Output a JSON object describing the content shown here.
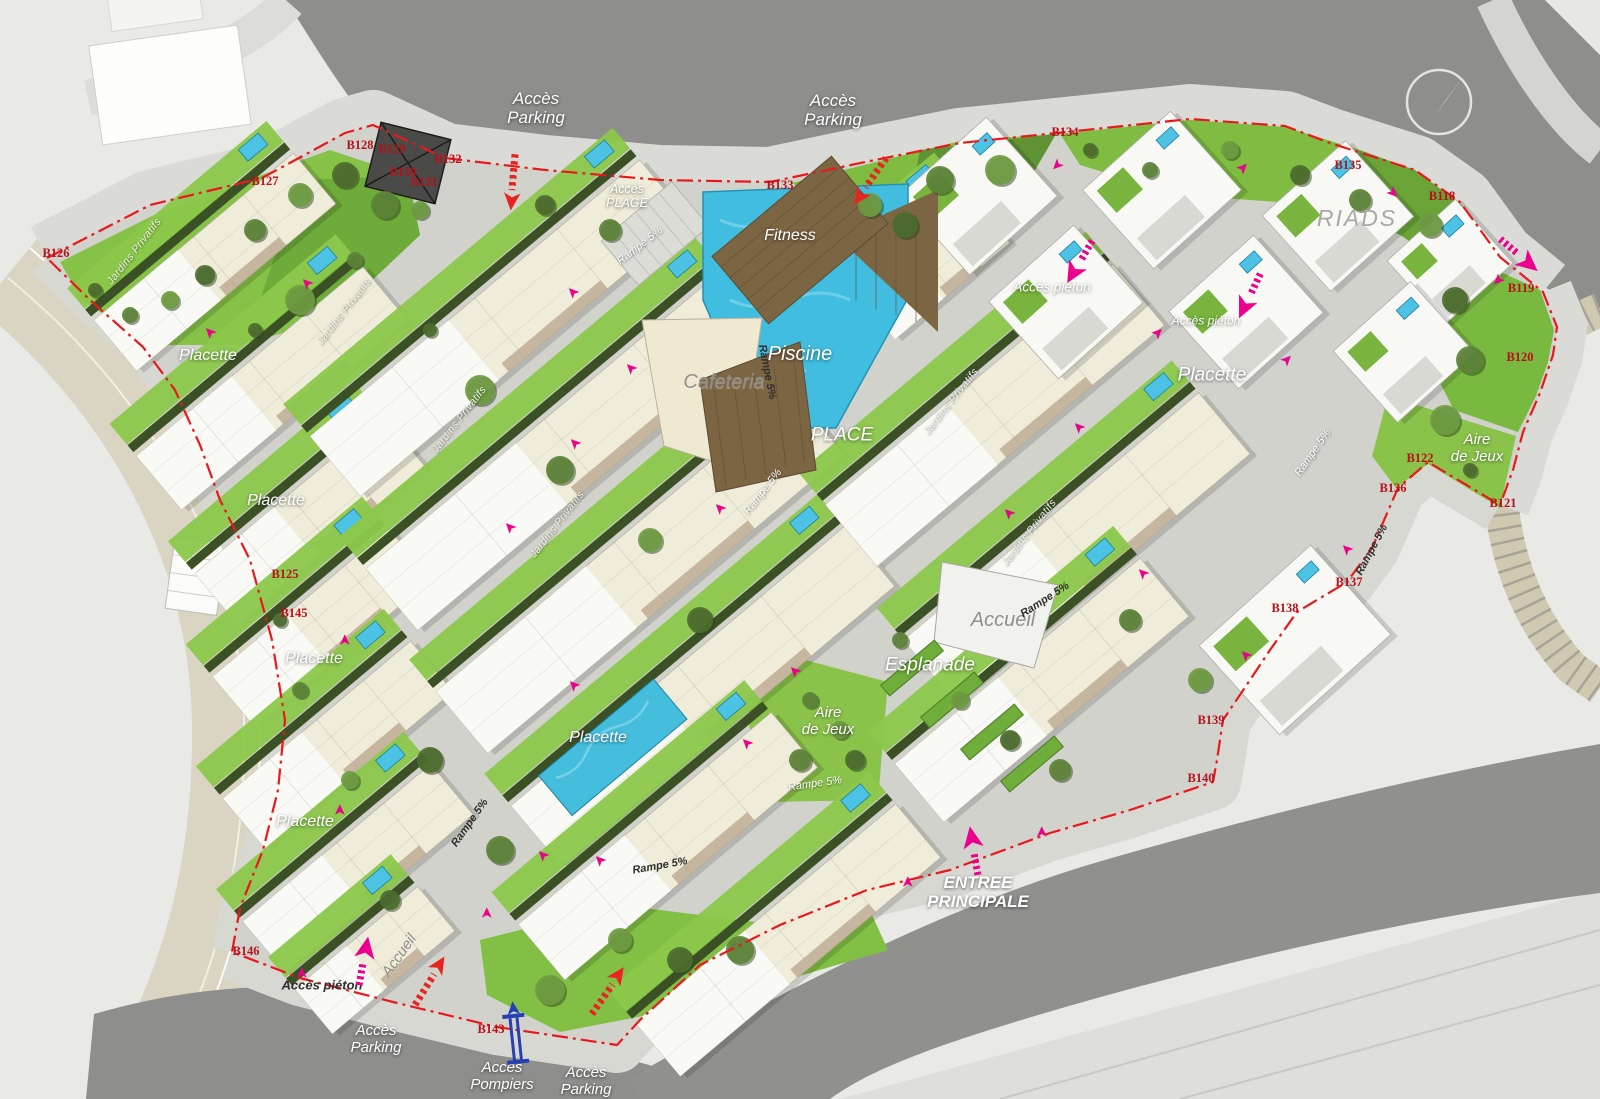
{
  "map": {
    "title": "Plan masse résidence",
    "colors": {
      "boundary_red": "#e8191c",
      "pedestrian_pink": "#ec008c",
      "vehicle_red": "#e8241f",
      "fire_access_blue": "#2440b3",
      "pool_blue": "#41bedf",
      "lawn_green": "#8bc84b",
      "road_gray": "#8e8e8c",
      "code_red": "#b5121b"
    },
    "compass": {
      "icon": "north-compass",
      "x": 1437,
      "y": 100
    },
    "labels": [
      {
        "text": "Accès\nParking",
        "x": 536,
        "y": 108,
        "cls": "access-white",
        "name": "acces-parking-nw"
      },
      {
        "text": "Accès\nParking",
        "x": 833,
        "y": 110,
        "cls": "access-white",
        "name": "acces-parking-n"
      },
      {
        "text": "Accès\nPLAGE",
        "x": 627,
        "y": 196,
        "cls": "access-white",
        "size": 12.5,
        "name": "acces-plage"
      },
      {
        "text": "Fitness",
        "x": 790,
        "y": 236,
        "cls": "area-white",
        "size": 16,
        "name": "fitness"
      },
      {
        "text": "Piscine",
        "x": 800,
        "y": 354,
        "cls": "area-white",
        "size": 20,
        "name": "piscine"
      },
      {
        "text": "Cafeteria",
        "x": 724,
        "y": 382,
        "cls": "area-gray",
        "size": 20,
        "name": "cafeteria"
      },
      {
        "text": "PLACE",
        "x": 842,
        "y": 435,
        "cls": "area-white",
        "size": 19,
        "name": "place"
      },
      {
        "text": "Accueil",
        "x": 1003,
        "y": 620,
        "cls": "area-gray",
        "size": 20,
        "name": "accueil"
      },
      {
        "text": "Esplanade",
        "x": 930,
        "y": 665,
        "cls": "area-white",
        "size": 19,
        "name": "esplanade"
      },
      {
        "text": "Aire\nde Jeux",
        "x": 828,
        "y": 722,
        "cls": "area-white",
        "size": 15,
        "name": "aire-de-jeux-centre"
      },
      {
        "text": "Aire\nde Jeux",
        "x": 1477,
        "y": 449,
        "cls": "area-white",
        "size": 15,
        "name": "aire-de-jeux-est"
      },
      {
        "text": "Placette",
        "x": 208,
        "y": 356,
        "cls": "area-white",
        "size": 16,
        "name": "placette-1"
      },
      {
        "text": "Placette",
        "x": 276,
        "y": 501,
        "cls": "area-white",
        "size": 16,
        "name": "placette-2"
      },
      {
        "text": "Placette",
        "x": 314,
        "y": 659,
        "cls": "area-white",
        "size": 16,
        "name": "placette-3"
      },
      {
        "text": "Placette",
        "x": 305,
        "y": 822,
        "cls": "area-white",
        "size": 16,
        "name": "placette-4"
      },
      {
        "text": "Placette",
        "x": 598,
        "y": 738,
        "cls": "area-white",
        "size": 16,
        "name": "placette-5"
      },
      {
        "text": "Placette",
        "x": 1212,
        "y": 375,
        "cls": "area-white",
        "size": 19,
        "name": "placette-6"
      },
      {
        "text": "Accès piéton",
        "x": 1052,
        "y": 287,
        "cls": "area-white",
        "size": 13.5,
        "name": "acces-pieton-1"
      },
      {
        "text": "Accès piéton",
        "x": 1206,
        "y": 321,
        "cls": "area-white",
        "size": 12,
        "name": "acces-pieton-2"
      },
      {
        "text": "Accès piéton",
        "x": 322,
        "y": 986,
        "cls": "access-dark",
        "size": 13,
        "name": "acces-pieton-3"
      },
      {
        "text": "ENTREE\nPRINCIPALE",
        "x": 978,
        "y": 892,
        "cls": "entree",
        "name": "entree-principale"
      },
      {
        "text": "RIADS",
        "x": 1357,
        "y": 219,
        "cls": "riads",
        "name": "riads"
      },
      {
        "text": "Accueil",
        "x": 400,
        "y": 956,
        "rot": -55,
        "cls": "area-gray",
        "size": 15,
        "name": "accueil-sud"
      },
      {
        "text": "Accès\nPompiers",
        "x": 502,
        "y": 1077,
        "cls": "access-white",
        "size": 15,
        "name": "acces-pompiers"
      },
      {
        "text": "Accès\nParking",
        "x": 376,
        "y": 1040,
        "cls": "access-white",
        "size": 15,
        "name": "acces-parking-sw"
      },
      {
        "text": "Accès\nParking",
        "x": 586,
        "y": 1082,
        "cls": "access-white",
        "size": 15,
        "name": "acces-parking-s"
      },
      {
        "text": "Jardins Privatifs",
        "x": 135,
        "y": 252,
        "rot": -52,
        "cls": "jardins",
        "name": "jardins-privatifs-1"
      },
      {
        "text": "Jardins Privatifs",
        "x": 345,
        "y": 312,
        "rot": -52,
        "cls": "jardins",
        "name": "jardins-privatifs-2"
      },
      {
        "text": "Jardins Privatifs",
        "x": 460,
        "y": 420,
        "rot": -52,
        "cls": "jardins",
        "name": "jardins-privatifs-3"
      },
      {
        "text": "Jardins Privatifs",
        "x": 558,
        "y": 525,
        "rot": -52,
        "cls": "jardins",
        "name": "jardins-privatifs-4"
      },
      {
        "text": "Jardins Privatifs",
        "x": 952,
        "y": 402,
        "rot": -52,
        "cls": "jardins",
        "name": "jardins-privatifs-5"
      },
      {
        "text": "Jardins Privatifs",
        "x": 1030,
        "y": 533,
        "rot": -52,
        "cls": "jardins",
        "name": "jardins-privatifs-6"
      },
      {
        "text": "Rampe 5%",
        "x": 640,
        "y": 246,
        "rot": -38,
        "cls": "rampe-light",
        "name": "rampe-1"
      },
      {
        "text": "Rampe 5%",
        "x": 767,
        "y": 372,
        "rot": 79,
        "cls": "rampe-dark",
        "name": "rampe-2"
      },
      {
        "text": "Rampe 5%",
        "x": 763,
        "y": 492,
        "rot": -52,
        "cls": "rampe-light",
        "name": "rampe-3"
      },
      {
        "text": "Rampe 5%",
        "x": 1045,
        "y": 600,
        "rot": -33,
        "cls": "rampe-dark",
        "name": "rampe-4"
      },
      {
        "text": "Rampe 5%",
        "x": 470,
        "y": 823,
        "rot": -55,
        "cls": "rampe-dark",
        "name": "rampe-5"
      },
      {
        "text": "Rampe 5%",
        "x": 660,
        "y": 866,
        "rot": -10,
        "cls": "rampe-dark",
        "name": "rampe-6"
      },
      {
        "text": "Rampe 5%",
        "x": 815,
        "y": 784,
        "rot": -8,
        "cls": "rampe-light",
        "name": "rampe-7"
      },
      {
        "text": "Rampe 5%",
        "x": 1313,
        "y": 453,
        "rot": -55,
        "cls": "rampe-light",
        "name": "rampe-8"
      },
      {
        "text": "Rampe 5%",
        "x": 1372,
        "y": 550,
        "rot": -62,
        "cls": "rampe-dark",
        "name": "rampe-9"
      }
    ],
    "codes": [
      {
        "text": "B128",
        "x": 360,
        "y": 145
      },
      {
        "text": "B129",
        "x": 392,
        "y": 149
      },
      {
        "text": "B132",
        "x": 448,
        "y": 159
      },
      {
        "text": "B130",
        "x": 403,
        "y": 172
      },
      {
        "text": "B131",
        "x": 424,
        "y": 182
      },
      {
        "text": "B127",
        "x": 265,
        "y": 181
      },
      {
        "text": "B126",
        "x": 56,
        "y": 253
      },
      {
        "text": "B133",
        "x": 780,
        "y": 185
      },
      {
        "text": "B134",
        "x": 1065,
        "y": 132
      },
      {
        "text": "B135",
        "x": 1348,
        "y": 165
      },
      {
        "text": "B118",
        "x": 1442,
        "y": 196
      },
      {
        "text": "B119",
        "x": 1521,
        "y": 288
      },
      {
        "text": "B120",
        "x": 1520,
        "y": 357
      },
      {
        "text": "B122",
        "x": 1420,
        "y": 458
      },
      {
        "text": "B136",
        "x": 1393,
        "y": 488
      },
      {
        "text": "B121",
        "x": 1503,
        "y": 503
      },
      {
        "text": "B125",
        "x": 285,
        "y": 574
      },
      {
        "text": "B145",
        "x": 294,
        "y": 613
      },
      {
        "text": "B137",
        "x": 1349,
        "y": 582
      },
      {
        "text": "B138",
        "x": 1285,
        "y": 608
      },
      {
        "text": "B139",
        "x": 1211,
        "y": 720
      },
      {
        "text": "B140",
        "x": 1201,
        "y": 778
      },
      {
        "text": "B143",
        "x": 491,
        "y": 1029
      },
      {
        "text": "B146",
        "x": 246,
        "y": 951
      }
    ],
    "arrows": {
      "pink_small": [
        [
          307,
          283,
          -135
        ],
        [
          210,
          332,
          -135
        ],
        [
          573,
          292,
          -135
        ],
        [
          631,
          368,
          -135
        ],
        [
          575,
          443,
          -135
        ],
        [
          510,
          527,
          -135
        ],
        [
          720,
          508,
          -135
        ],
        [
          345,
          640,
          -90
        ],
        [
          340,
          810,
          -90
        ],
        [
          302,
          973,
          -90
        ],
        [
          543,
          855,
          -135
        ],
        [
          574,
          685,
          -135
        ],
        [
          600,
          860,
          -135
        ],
        [
          795,
          671,
          -135
        ],
        [
          747,
          743,
          -135
        ],
        [
          908,
          882,
          -90
        ],
        [
          1042,
          832,
          -90
        ],
        [
          1143,
          573,
          -135
        ],
        [
          1246,
          655,
          -135
        ],
        [
          1347,
          549,
          -135
        ],
        [
          1079,
          427,
          -135
        ],
        [
          1009,
          513,
          -135
        ],
        [
          1158,
          333,
          -45
        ],
        [
          1287,
          360,
          -45
        ],
        [
          1057,
          165,
          135
        ],
        [
          1243,
          168,
          -45
        ],
        [
          1393,
          193,
          45
        ],
        [
          1498,
          280,
          135
        ],
        [
          487,
          913,
          -90
        ]
      ],
      "pink_big": [
        [
          1080,
          263,
          120
        ],
        [
          1250,
          297,
          115
        ],
        [
          1520,
          255,
          40
        ],
        [
          363,
          960,
          -80
        ],
        [
          973,
          850,
          -100
        ]
      ],
      "red": [
        [
          513,
          183,
          95
        ],
        [
          870,
          182,
          125
        ],
        [
          430,
          980,
          -58
        ],
        [
          608,
          990,
          -55
        ]
      ],
      "fire_blue": [
        [
          515,
          1032,
          -96
        ]
      ]
    }
  }
}
